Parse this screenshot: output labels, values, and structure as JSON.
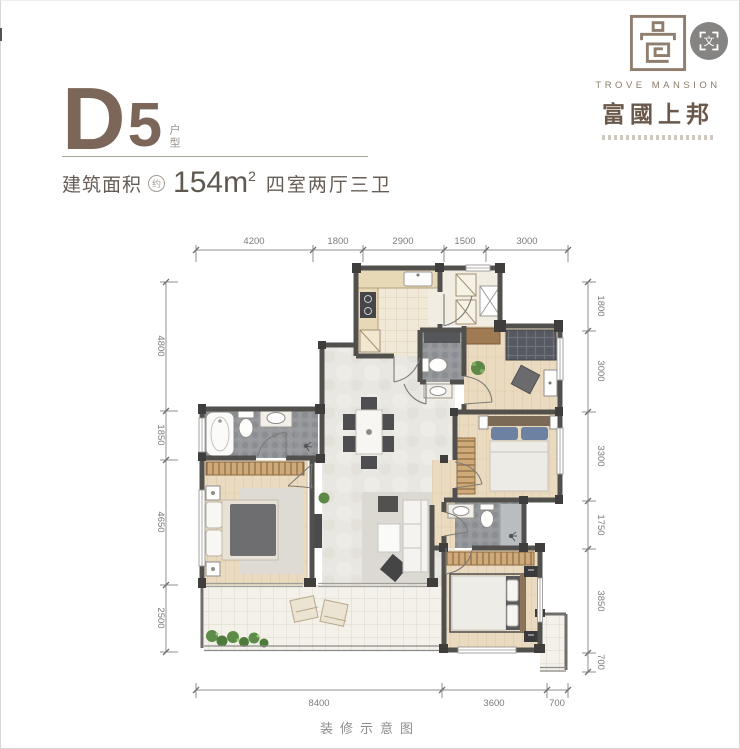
{
  "header": {
    "unit_letter": "D",
    "unit_number": "5",
    "unit_suffix": "户型",
    "area_label": "建筑面积",
    "area_approx": "约",
    "area_value": "154m",
    "area_exponent": "2",
    "rooms_text": "四室两厅三卫"
  },
  "brand": {
    "name_en": "TROVE MANSION",
    "name_cn": "富國上邦"
  },
  "overlay": {
    "translate_glyph": "文"
  },
  "plan": {
    "caption": "装修示意图",
    "dims": {
      "top": [
        "4200",
        "1800",
        "2900",
        "1500",
        "3000"
      ],
      "left": [
        "4800",
        "1850",
        "4650",
        "2500"
      ],
      "right": [
        "1800",
        "3000",
        "3300",
        "1750",
        "3850",
        "700"
      ],
      "bottom": [
        "8400",
        "3600",
        "700"
      ]
    }
  },
  "colors": {
    "brand_brown": "#7b6659",
    "wall": "#52504d",
    "wood_floor": "#eadabf",
    "marble_floor": "#e9e7e2",
    "dark_tile": "#97999c",
    "kitchen_tile": "#f0e9d8",
    "balcony_tile": "#f3f1ea",
    "wardrobe": "#cfa977",
    "bed_blue": "#6d81a3",
    "plant_green": "#5c8a46"
  }
}
